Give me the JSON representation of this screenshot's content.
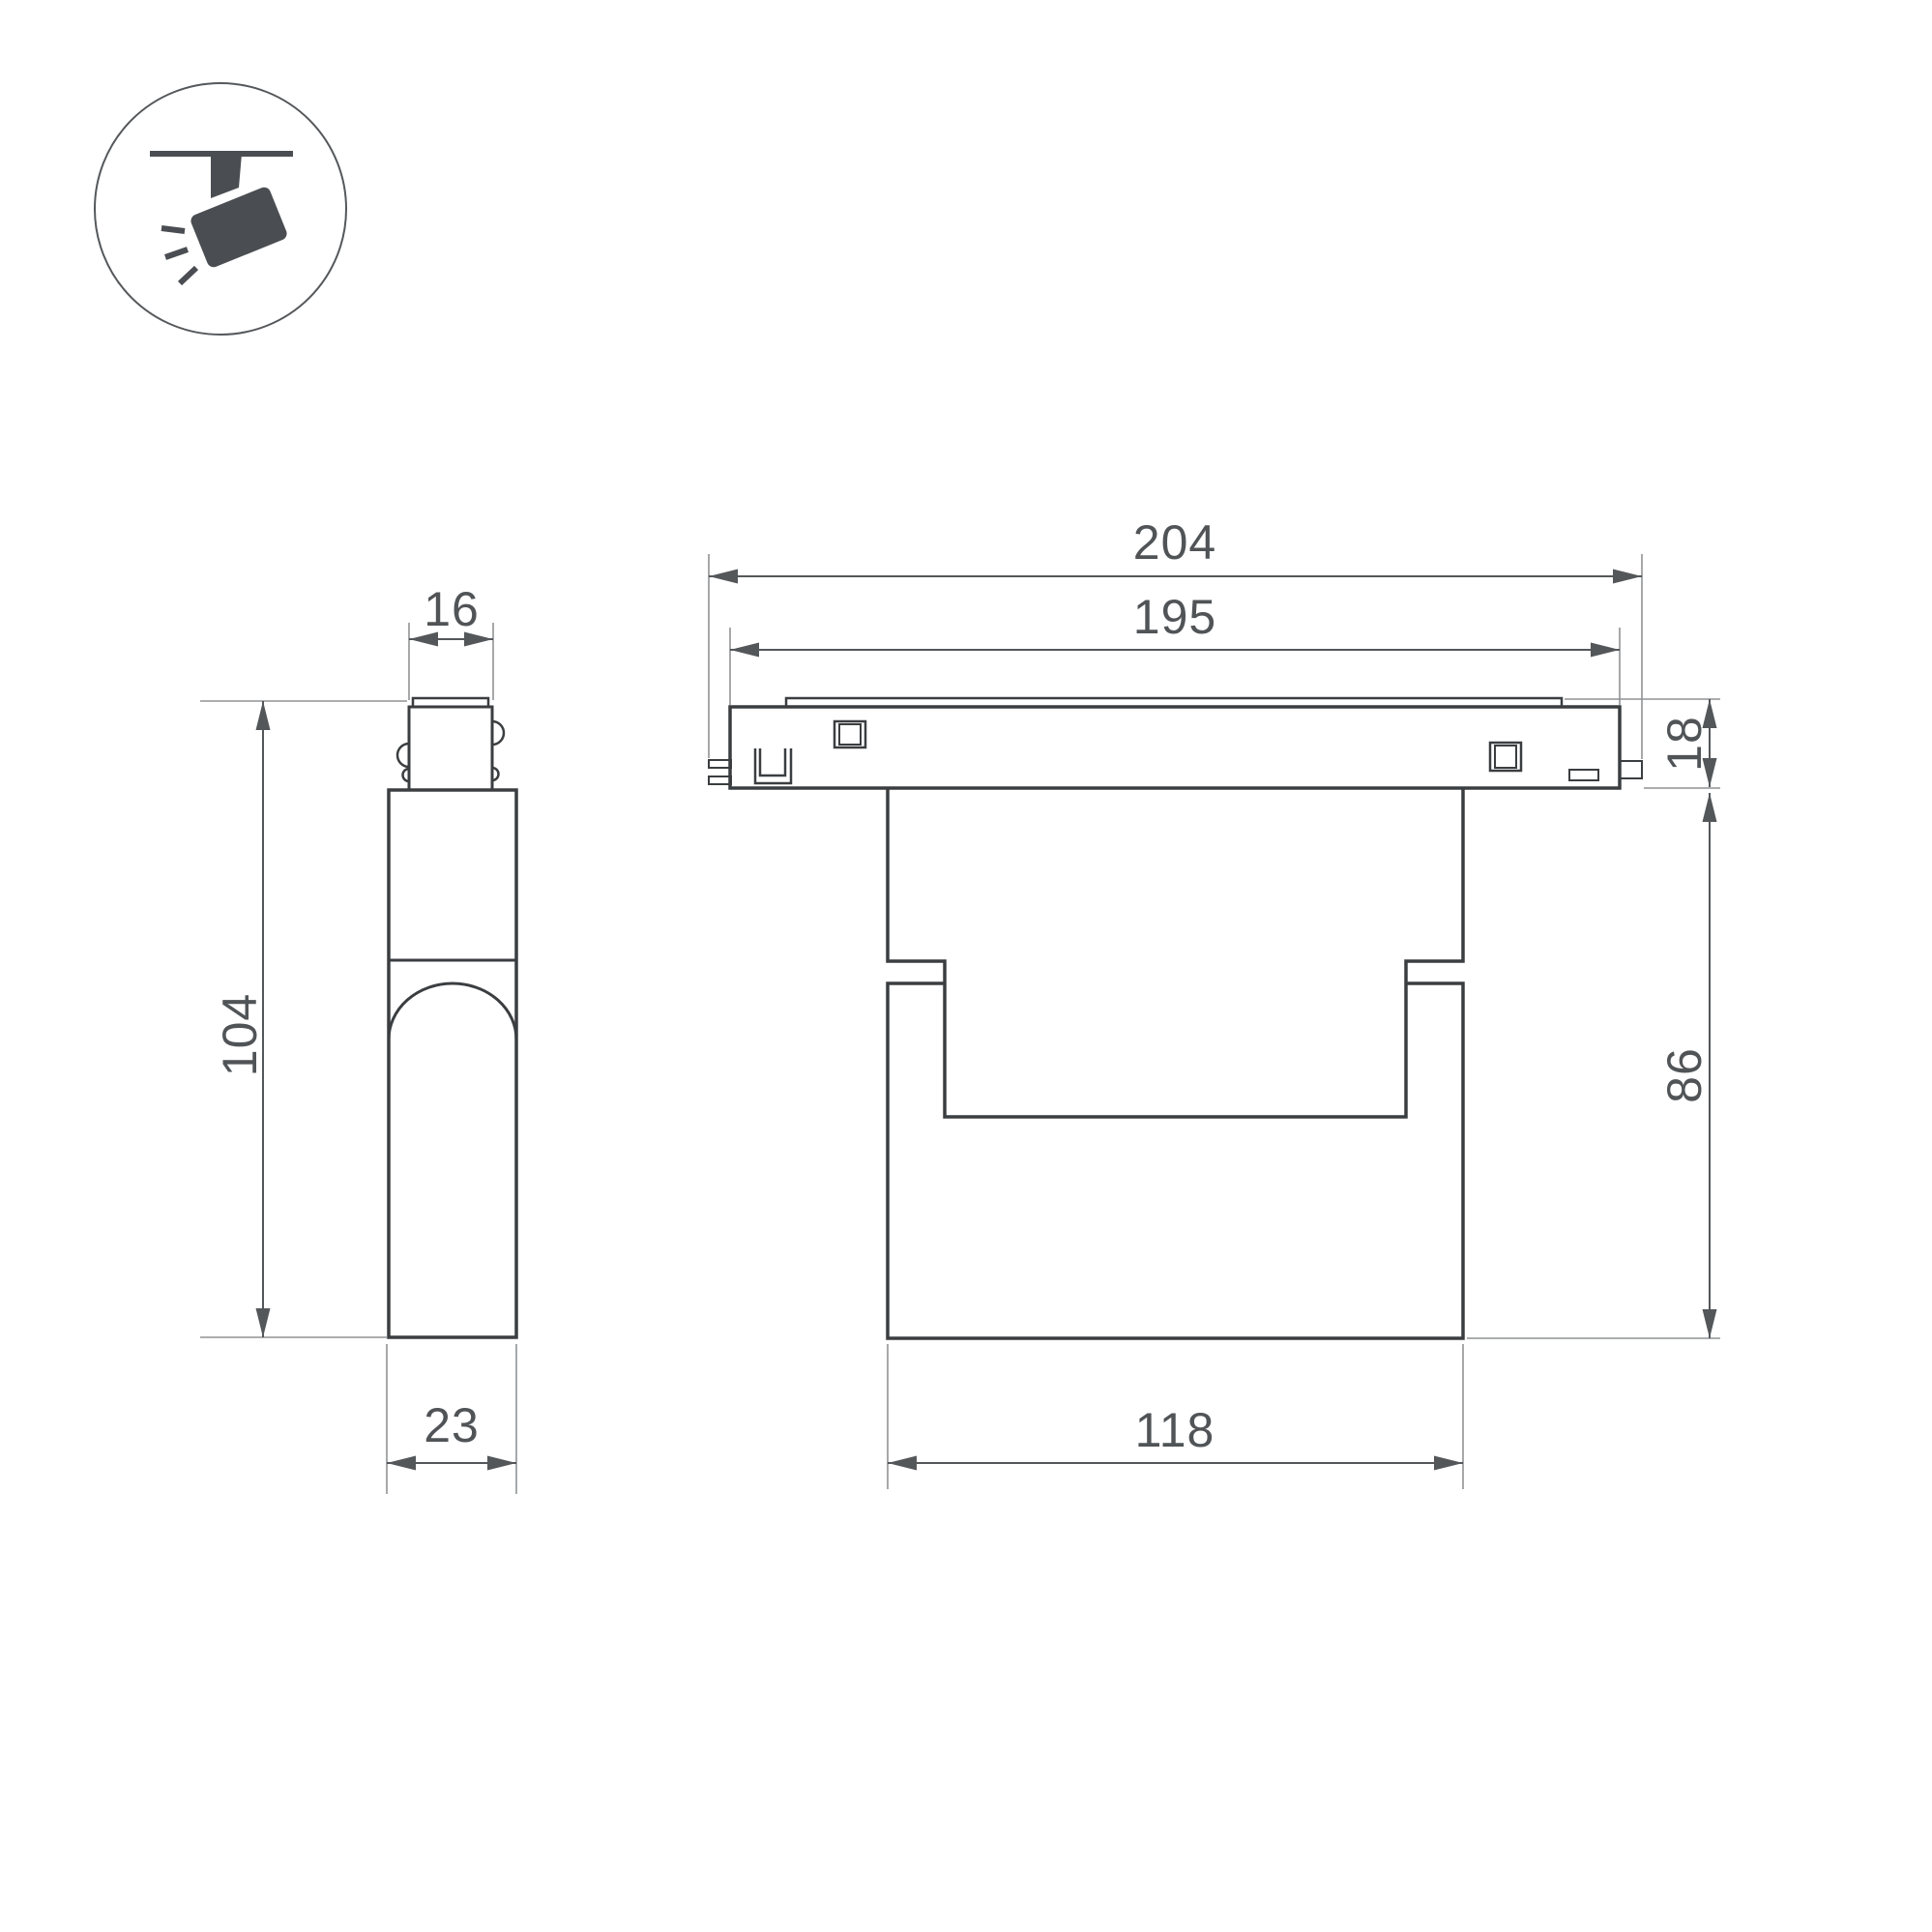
{
  "drawing": {
    "kind": "track-light-fixture-dimension-drawing",
    "views": [
      "side-view",
      "front-view"
    ]
  },
  "colors": {
    "background": "#ffffff",
    "outline": "#3b3e40",
    "detail_outline": "#46494c",
    "dimension": "#54575a",
    "extension": "#8f9294",
    "text": "#515457",
    "icon_glyph": "#4a4e52",
    "icon_circle_stroke": "#55585b"
  },
  "icon": {
    "type": "track-spotlight-icon"
  },
  "side_view": {
    "top_width": "16",
    "height": "104",
    "depth": "23"
  },
  "front_view": {
    "overall_length": "204",
    "track_length": "195",
    "track_height": "18",
    "body_height": "86",
    "body_width": "118"
  }
}
